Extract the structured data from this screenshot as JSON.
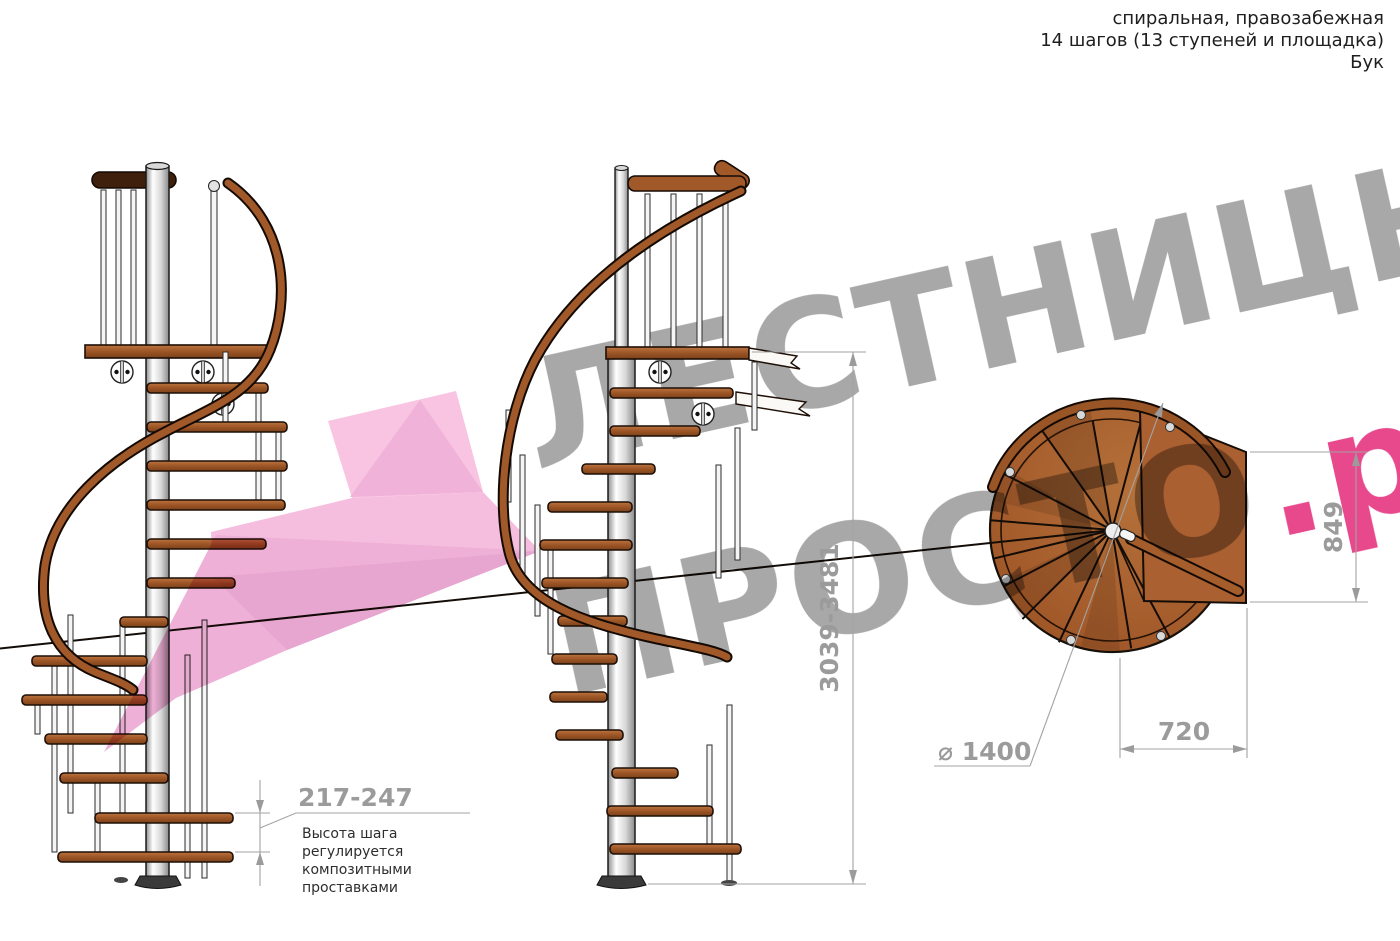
{
  "header": {
    "line1": "спиральная, правозабежная",
    "line2": "14 шагов (13 ступеней и площадка)",
    "line3": "Бук"
  },
  "watermark": {
    "word1": "ЛЕСТНИЦЫ",
    "word2": "ПРОСТО",
    "suffix": ".ру",
    "gray": "#a8a8a8",
    "pink": "#e8498d",
    "arrow_pink": "#f6bede"
  },
  "dimensions": {
    "step_height": "217-247",
    "total_height": "3039-3481",
    "landing_depth": "849",
    "landing_width": "720",
    "diameter": "⌀ 1400"
  },
  "note": {
    "line1": "Высота шага",
    "line2": "регулируется",
    "line3": "композитными",
    "line4": "проставками"
  },
  "colors": {
    "wood": "#a2592a",
    "wood_light": "#c07a3d",
    "wood_dark": "#6e3a15",
    "rail_dark": "#3f200d",
    "metal_pole": "#e8e8e8",
    "dim_gray": "#9b9b9b"
  }
}
